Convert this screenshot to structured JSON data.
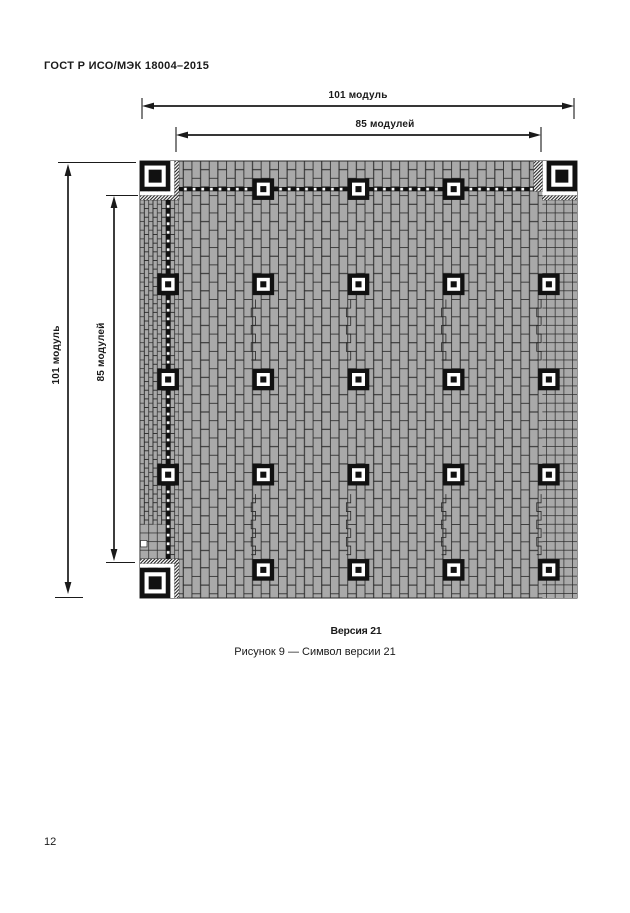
{
  "page": {
    "header": "ГОСТ Р ИСО/МЭК 18004–2015",
    "page_number": "12"
  },
  "figure": {
    "dim_width_total": "101 модуль",
    "dim_width_inner": "85 модулей",
    "dim_height_total": "101 модуль",
    "dim_height_inner": "85 модулей",
    "version_label": "Версия 21",
    "caption": "Рисунок 9 — Символ версии 21"
  },
  "qr": {
    "version": 21,
    "modules_per_side": 101,
    "inner_span_modules": 85,
    "alignment_centers": [
      6,
      28,
      50,
      72,
      94
    ],
    "finder_corners": [
      "top-left",
      "top-right",
      "bottom-left"
    ],
    "timing_row": 6,
    "timing_col": 6,
    "stair_columns": [
      28,
      50,
      72,
      94
    ],
    "stair_row_intervals": [
      [
        32,
        46
      ],
      [
        77,
        90
      ]
    ]
  },
  "colors": {
    "ink": "#1a1a1a",
    "black": "#111111",
    "brick_fill": "#a9a9a9",
    "brick_line": "#262626",
    "white": "#ffffff"
  }
}
